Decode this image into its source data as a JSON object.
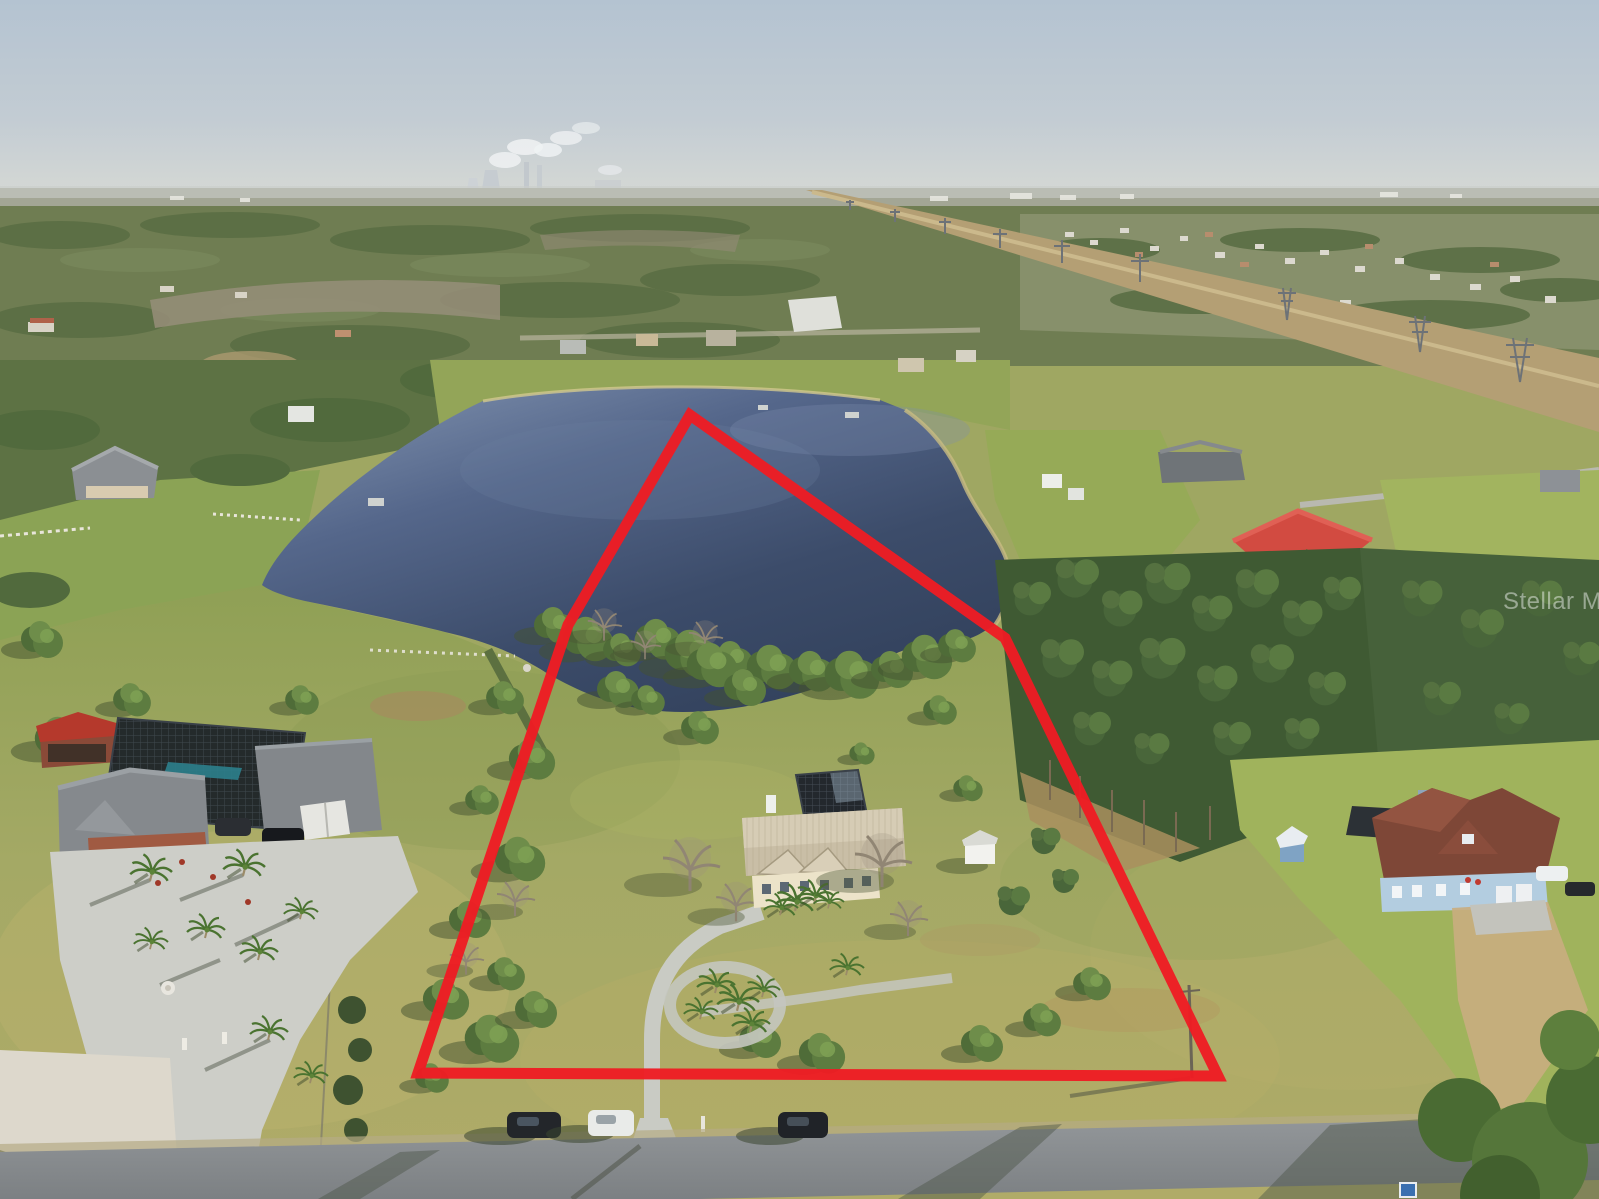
{
  "watermark": {
    "text": "Stellar MLS"
  },
  "scene": {
    "description": "Aerial drone photograph of a lakefront acreage home site outlined with a red property boundary; a large pond at top, a cream house with screened pool cage in the center parcel, neighboring homes on either side, distant suburb and power plant on the horizon, and a street with parked cars in the foreground",
    "colors": {
      "boundary_red": "#ee1c23",
      "sky_top": "#b4c3d1",
      "sky_horizon": "#d3d7d5",
      "lake_dark": "#3c4c6a",
      "lake_light": "#8496b2",
      "grass": "#a4a965",
      "road": "#8d9194",
      "watermark_white": "#ffffff"
    }
  }
}
